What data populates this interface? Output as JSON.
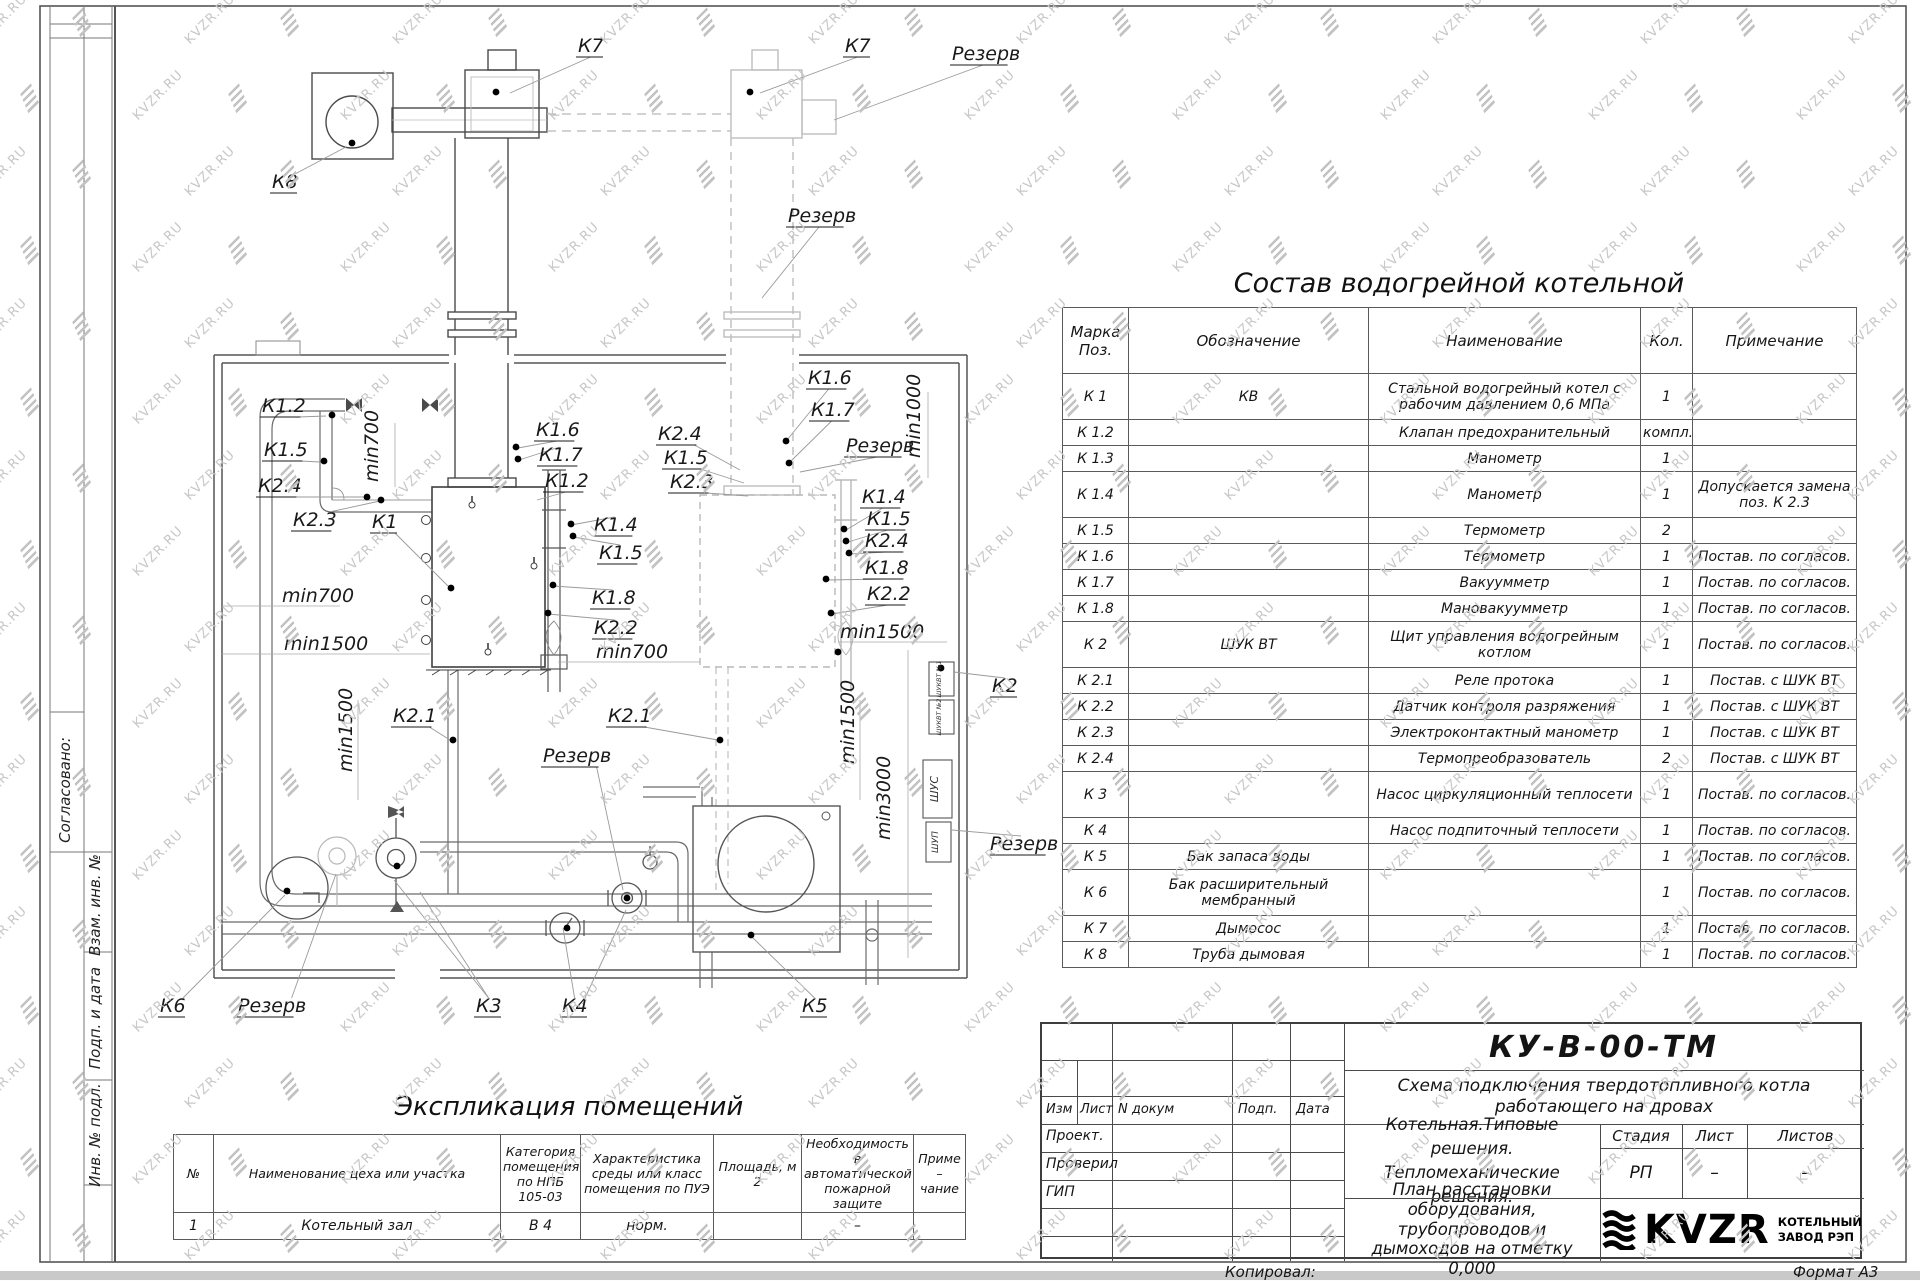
{
  "watermark": {
    "text": "KVZR.RU"
  },
  "frame": {
    "left_labels": [
      "Согласовано:",
      "Взам. инв. №",
      "Подп. и дата",
      "Инв. № подл."
    ],
    "copied_label": "Копировал:",
    "format_label": "Формат А3"
  },
  "composition_table": {
    "title": "Состав водогрейной котельной",
    "headers": {
      "mark": "Марка Поз.",
      "designation": "Обозначение",
      "name": "Наименование",
      "qty": "Кол.",
      "note": "Примечание"
    },
    "rows": [
      {
        "mark": "К 1",
        "designation": "КВ",
        "name": "Стальной водогрейный котел с рабочим давлением 0,6  МПа",
        "qty": "1",
        "note": "",
        "h": 2
      },
      {
        "mark": "К 1.2",
        "designation": "",
        "name": "Клапан предохранительный",
        "qty": "компл.",
        "note": "",
        "h": 1
      },
      {
        "mark": "К 1.3",
        "designation": "",
        "name": "Манометр",
        "qty": "1",
        "note": "",
        "h": 1
      },
      {
        "mark": "К 1.4",
        "designation": "",
        "name": "Манометр",
        "qty": "1",
        "note": "Допускается замена поз. К 2.3",
        "h": 2
      },
      {
        "mark": "К 1.5",
        "designation": "",
        "name": "Термометр",
        "qty": "2",
        "note": "",
        "h": 1
      },
      {
        "mark": "К 1.6",
        "designation": "",
        "name": "Термометр",
        "qty": "1",
        "note": "Постав. по согласов.",
        "h": 1
      },
      {
        "mark": "К 1.7",
        "designation": "",
        "name": "Вакуумметр",
        "qty": "1",
        "note": "Постав. по согласов.",
        "h": 1
      },
      {
        "mark": "К 1.8",
        "designation": "",
        "name": "Мановакуумметр",
        "qty": "1",
        "note": "Постав. по согласов.",
        "h": 1
      },
      {
        "mark": "К 2",
        "designation": "ШУК ВТ",
        "name": "Щит управления водогрейным котлом",
        "qty": "1",
        "note": "Постав. по согласов.",
        "h": 2
      },
      {
        "mark": "К 2.1",
        "designation": "",
        "name": "Реле протока",
        "qty": "1",
        "note": "Постав. с ШУК ВТ",
        "h": 1
      },
      {
        "mark": "К 2.2",
        "designation": "",
        "name": "Датчик контроля разряжения",
        "qty": "1",
        "note": "Постав. с ШУК ВТ",
        "h": 1
      },
      {
        "mark": "К 2.3",
        "designation": "",
        "name": "Электроконтактный манометр",
        "qty": "1",
        "note": "Постав. с ШУК ВТ",
        "h": 1
      },
      {
        "mark": "К 2.4",
        "designation": "",
        "name": "Термопреобразователь",
        "qty": "2",
        "note": "Постав. с ШУК ВТ",
        "h": 1
      },
      {
        "mark": "К 3",
        "designation": "",
        "name": "Насос циркуляционный теплосети",
        "qty": "1",
        "note": "Постав. по согласов.",
        "h": 2
      },
      {
        "mark": "К 4",
        "designation": "",
        "name": "Насос подпиточный теплосети",
        "qty": "1",
        "note": "Постав. по согласов.",
        "h": 1
      },
      {
        "mark": "К 5",
        "designation": "Бак запаса воды",
        "name": "",
        "qty": "1",
        "note": "Постав. по согласов.",
        "h": 1
      },
      {
        "mark": "К 6",
        "designation": "Бак расширительный мембранный",
        "name": "",
        "qty": "1",
        "note": "Постав. по согласов.",
        "h": 2
      },
      {
        "mark": "К 7",
        "designation": "Дымосос",
        "name": "",
        "qty": "1",
        "note": "Постав. по согласов.",
        "h": 1
      },
      {
        "mark": "К 8",
        "designation": "Труба дымовая",
        "name": "",
        "qty": "1",
        "note": "Постав. по согласов.",
        "h": 1
      }
    ]
  },
  "explication_table": {
    "title": "Экспликация помещений",
    "headers": [
      "№",
      "Наименование цеха или участка",
      "Категория помещения по НПБ 105-03",
      "Характеристика среды или класс помещения по ПУЭ",
      "Площадь, м 2",
      "Необходимость в автоматической пожарной защите",
      "Приме – чание"
    ],
    "rows": [
      [
        "1",
        "Котельный зал",
        "В 4",
        "норм.",
        "",
        "–",
        ""
      ]
    ]
  },
  "title_block": {
    "doc_number": "КУ-В-00-ТМ",
    "subtitle": "Схема подключения твердотопливного котла работающего на дровах",
    "change_header": [
      "Изм",
      "Лист",
      "N докум",
      "Подп.",
      "Дата"
    ],
    "roles": [
      "Проект.",
      "Проверил",
      "ГИП"
    ],
    "project_name_line1": "Котельная.Типовые решения.",
    "project_name_line2": "Тепломеханические решения.",
    "sheet_title": "План расстановки оборудования, трубопроводов и дымоходов на отметку  0,000",
    "stage_header": "Стадия",
    "sheet_header": "Лист",
    "sheets_header": "Листов",
    "stage": "РП",
    "sheet": "–",
    "sheets": "–",
    "logo_text": "KVZR",
    "logo_caption_line1": "КОТЕЛЬНЫЙ",
    "logo_caption_line2": "ЗАВОД РЭП"
  },
  "drawing": {
    "labels": [
      {
        "t": "К7",
        "x": 578,
        "y": 52,
        "u": 1,
        "leads": [
          [
            510,
            93
          ]
        ]
      },
      {
        "t": "К7",
        "x": 845,
        "y": 52,
        "u": 1,
        "leads": [
          [
            760,
            93
          ]
        ]
      },
      {
        "t": "Резерв",
        "x": 952,
        "y": 60,
        "u": 1,
        "leads": [
          [
            834,
            120
          ]
        ]
      },
      {
        "t": "К8",
        "x": 272,
        "y": 188,
        "u": 1,
        "leads": [
          [
            346,
            147
          ]
        ]
      },
      {
        "t": "Резерв",
        "x": 788,
        "y": 222,
        "u": 1,
        "leads": [
          [
            762,
            298
          ]
        ]
      },
      {
        "t": "К1.2",
        "x": 262,
        "y": 412,
        "u": 1,
        "leads": [
          [
            326,
            416
          ]
        ]
      },
      {
        "t": "К1.5",
        "x": 264,
        "y": 456,
        "u": 1,
        "leads": [
          [
            320,
            462
          ]
        ]
      },
      {
        "t": "К2.4",
        "x": 258,
        "y": 492,
        "u": 1,
        "leads": [
          [
            364,
            497
          ]
        ]
      },
      {
        "t": "К2.3",
        "x": 293,
        "y": 526,
        "u": 1,
        "leads": [
          [
            380,
            501
          ]
        ]
      },
      {
        "t": "К1",
        "x": 372,
        "y": 528,
        "u": 1,
        "leads": [
          [
            449,
            587
          ]
        ]
      },
      {
        "t": "min700",
        "x": 378,
        "y": 482,
        "v": 1
      },
      {
        "t": "min700",
        "x": 282,
        "y": 602
      },
      {
        "t": "min1500",
        "x": 284,
        "y": 650
      },
      {
        "t": "min1500",
        "x": 352,
        "y": 772,
        "v": 1
      },
      {
        "t": "К2.1",
        "x": 393,
        "y": 722,
        "u": 1,
        "leads": [
          [
            450,
            740
          ]
        ]
      },
      {
        "t": "К1.6",
        "x": 536,
        "y": 436,
        "u": 1,
        "leads": [
          [
            518,
            448
          ]
        ]
      },
      {
        "t": "К1.7",
        "x": 539,
        "y": 461,
        "u": 1,
        "leads": [
          [
            519,
            460
          ]
        ]
      },
      {
        "t": "К1.2",
        "x": 545,
        "y": 487,
        "u": 1,
        "leads": [
          [
            537,
            500
          ]
        ]
      },
      {
        "t": "К2.4",
        "x": 658,
        "y": 440,
        "u": 1,
        "leads": [
          [
            740,
            470
          ]
        ]
      },
      {
        "t": "К1.5",
        "x": 664,
        "y": 464,
        "u": 1,
        "leads": [
          [
            744,
            483
          ]
        ]
      },
      {
        "t": "К2.3",
        "x": 670,
        "y": 488,
        "u": 1,
        "leads": [
          [
            748,
            496
          ]
        ]
      },
      {
        "t": "К1.4",
        "x": 594,
        "y": 531,
        "u": 1,
        "leads": [
          [
            571,
            525
          ]
        ]
      },
      {
        "t": "К1.5",
        "x": 599,
        "y": 559,
        "u": 1,
        "leads": [
          [
            573,
            537
          ]
        ]
      },
      {
        "t": "К1.8",
        "x": 592,
        "y": 604,
        "u": 1,
        "leads": [
          [
            553,
            586
          ]
        ]
      },
      {
        "t": "К2.2",
        "x": 594,
        "y": 634,
        "u": 1,
        "leads": [
          [
            548,
            614
          ]
        ]
      },
      {
        "t": "min700",
        "x": 596,
        "y": 658
      },
      {
        "t": "К1.6",
        "x": 808,
        "y": 384,
        "u": 1,
        "leads": [
          [
            787,
            440
          ]
        ]
      },
      {
        "t": "К1.7",
        "x": 811,
        "y": 416,
        "u": 1,
        "leads": [
          [
            790,
            462
          ]
        ]
      },
      {
        "t": "Резерв",
        "x": 846,
        "y": 452,
        "u": 1,
        "leads": [
          [
            800,
            472
          ]
        ]
      },
      {
        "t": "min1000",
        "x": 920,
        "y": 458,
        "v": 1
      },
      {
        "t": "К1.4",
        "x": 862,
        "y": 503,
        "u": 1,
        "leads": [
          [
            846,
            530
          ]
        ]
      },
      {
        "t": "К1.5",
        "x": 867,
        "y": 525,
        "u": 1,
        "leads": [
          [
            848,
            542
          ]
        ]
      },
      {
        "t": "К2.4",
        "x": 865,
        "y": 547,
        "u": 1,
        "leads": [
          [
            850,
            554
          ]
        ]
      },
      {
        "t": "К1.8",
        "x": 865,
        "y": 574,
        "u": 1,
        "leads": [
          [
            827,
            580
          ]
        ]
      },
      {
        "t": "К2.2",
        "x": 867,
        "y": 600,
        "u": 1,
        "leads": [
          [
            832,
            614
          ]
        ]
      },
      {
        "t": "min1500",
        "x": 840,
        "y": 638
      },
      {
        "t": "min1500",
        "x": 854,
        "y": 764,
        "v": 1
      },
      {
        "t": "К2.1",
        "x": 608,
        "y": 722,
        "u": 1,
        "leads": [
          [
            718,
            740
          ]
        ]
      },
      {
        "t": "К2",
        "x": 992,
        "y": 692,
        "u": 1,
        "leads": [
          [
            954,
            672
          ]
        ]
      },
      {
        "t": "Резерв",
        "x": 990,
        "y": 850,
        "u": 1,
        "leads": [
          [
            952,
            830
          ]
        ]
      },
      {
        "t": "min3000",
        "x": 890,
        "y": 840,
        "v": 1
      },
      {
        "t": "Резерв",
        "x": 543,
        "y": 762,
        "u": 1,
        "leads": [
          [
            623,
            890
          ]
        ]
      },
      {
        "t": "К6",
        "x": 160,
        "y": 1012,
        "u": 1,
        "leads": [
          [
            285,
            895
          ]
        ]
      },
      {
        "t": "Резерв",
        "x": 238,
        "y": 1012,
        "u": 1,
        "leads": [
          [
            336,
            874
          ]
        ]
      },
      {
        "t": "К3",
        "x": 476,
        "y": 1012,
        "u": 1,
        "leads": [
          [
            394,
            880
          ],
          [
            420,
            892
          ]
        ]
      },
      {
        "t": "К4",
        "x": 562,
        "y": 1012,
        "u": 1,
        "leads": [
          [
            563,
            928
          ],
          [
            626,
            910
          ]
        ]
      },
      {
        "t": "К5",
        "x": 802,
        "y": 1012,
        "u": 1,
        "leads": [
          [
            751,
            936
          ]
        ]
      }
    ],
    "dots": [
      [
        496,
        92
      ],
      [
        750,
        92
      ],
      [
        352,
        143
      ],
      [
        332,
        415
      ],
      [
        324,
        461
      ],
      [
        367,
        497
      ],
      [
        381,
        500
      ],
      [
        451,
        588
      ],
      [
        453,
        740
      ],
      [
        516,
        447
      ],
      [
        518,
        459
      ],
      [
        786,
        441
      ],
      [
        789,
        463
      ],
      [
        571,
        524
      ],
      [
        573,
        536
      ],
      [
        553,
        585
      ],
      [
        548,
        613
      ],
      [
        844,
        529
      ],
      [
        846,
        541
      ],
      [
        849,
        553
      ],
      [
        826,
        579
      ],
      [
        831,
        613
      ],
      [
        720,
        740
      ],
      [
        941,
        668
      ],
      [
        287,
        891
      ],
      [
        397,
        866
      ],
      [
        567,
        928
      ],
      [
        627,
        898
      ],
      [
        751,
        935
      ],
      [
        838,
        652
      ]
    ],
    "box_labels": [
      {
        "t": "ШУКВТ №1",
        "x": 941,
        "y": 679,
        "s": 6.5
      },
      {
        "t": "ШУКВТ №2",
        "x": 941,
        "y": 717,
        "s": 6.5
      },
      {
        "t": "ШУС",
        "x": 938,
        "y": 789,
        "s": 11
      },
      {
        "t": "ШУП",
        "x": 938,
        "y": 842,
        "s": 9
      }
    ]
  }
}
